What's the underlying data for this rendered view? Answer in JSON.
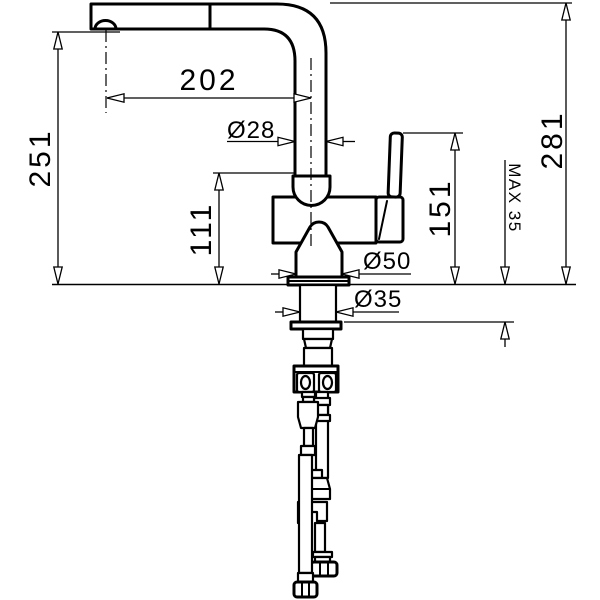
{
  "colors": {
    "line": "#000000",
    "background": "#ffffff"
  },
  "dims": {
    "spout_reach": "202",
    "spout_height": "251",
    "total_height": "281",
    "body_height": "111",
    "lever_height": "151",
    "max_deck": "MAX 35",
    "dia_spout_pipe": "Ø28",
    "dia_base": "Ø50",
    "dia_shank": "Ø35"
  }
}
